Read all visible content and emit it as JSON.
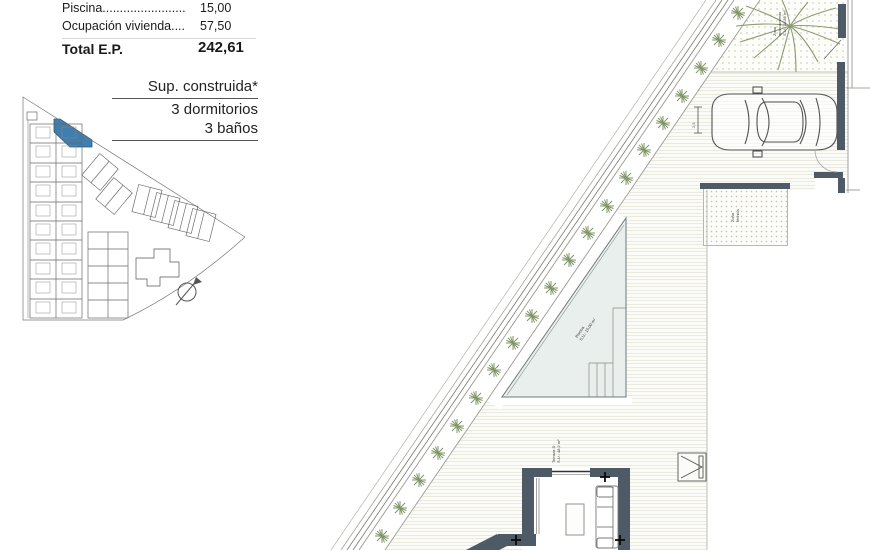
{
  "summary_table": {
    "rows": [
      {
        "label": "Piscina........................",
        "value": "15,00"
      },
      {
        "label": "Ocupación vivienda....",
        "value": "57,50"
      },
      {
        "label": "Total E.P.",
        "value": "242,61"
      }
    ]
  },
  "unit_info": {
    "title": "Sup. construida*",
    "bedrooms": "3 dormitorios",
    "bathrooms": "3 baños"
  },
  "plan_labels": {
    "terrace_name": "Terraza D",
    "terrace_area": "S.U.: 48,2 m²",
    "pool_name": "Piscina",
    "pool_area": "S.U.: 15,00 m²",
    "parking_l1": "Zona",
    "parking_l2": "aparcamiento",
    "parking_l3": "S.U.: 18,85 m²",
    "tech_l1": "Zona",
    "tech_l2": "técnica",
    "car_dimension": "2,5"
  },
  "colors": {
    "highlight_unit": "#3f7eae",
    "wall": "#4e5a66",
    "deck_line": "#d8d8cb",
    "plant": "#7f9465",
    "pool_fill": "#e9efec"
  }
}
